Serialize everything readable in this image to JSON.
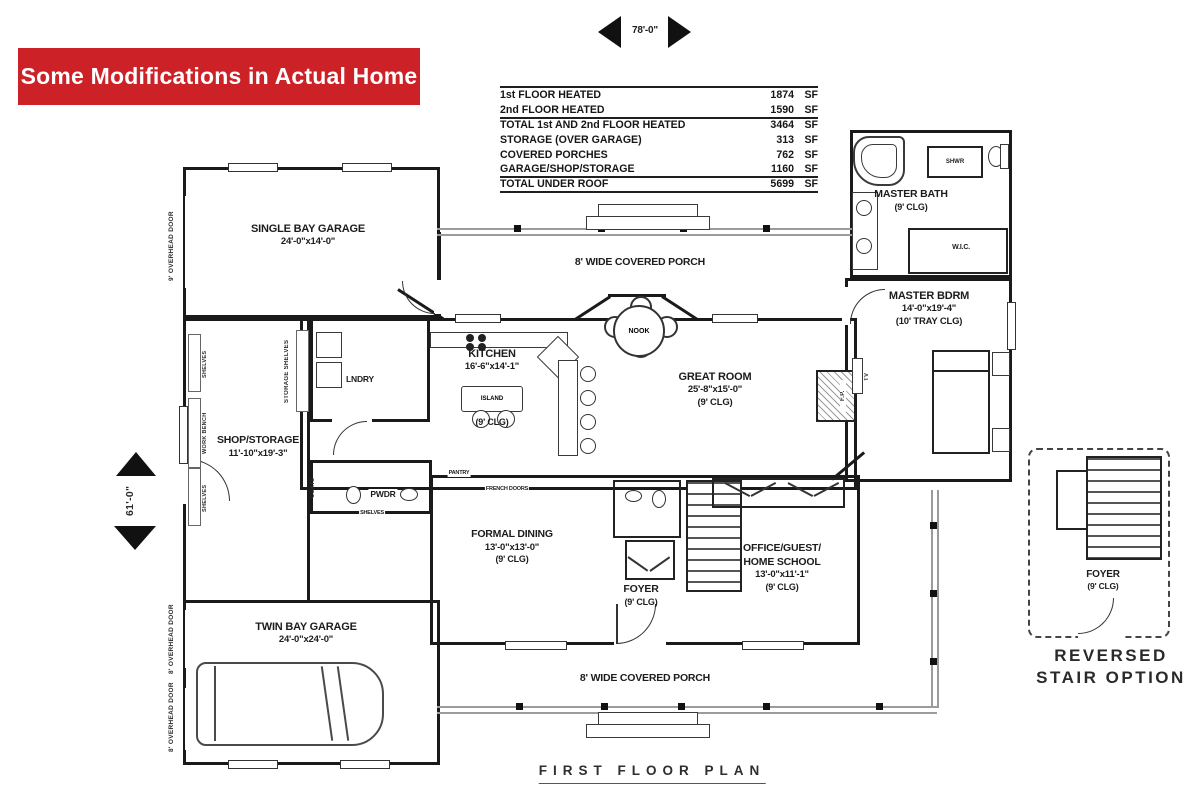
{
  "banner": {
    "text": "Some Modifications in Actual Home",
    "bg": "#cb2127"
  },
  "dimensions": {
    "top": "78'-0\"",
    "left": "61'-0\""
  },
  "area_table": {
    "unit": "SF",
    "rows": [
      {
        "label": "1st FLOOR HEATED",
        "value": "1874"
      },
      {
        "label": "2nd FLOOR HEATED",
        "value": "1590"
      },
      {
        "label": "TOTAL 1st AND 2nd FLOOR HEATED",
        "value": "3464"
      },
      {
        "label": "STORAGE (OVER GARAGE)",
        "value": "313"
      },
      {
        "label": "COVERED PORCHES",
        "value": "762"
      },
      {
        "label": "GARAGE/SHOP/STORAGE",
        "value": "1160"
      },
      {
        "label": "TOTAL UNDER ROOF",
        "value": "5699"
      }
    ]
  },
  "rooms": {
    "single_bay_garage": {
      "name": "SINGLE BAY GARAGE",
      "dims": "24'-0\"x14'-0\""
    },
    "porch_top": {
      "name": "8' WIDE COVERED PORCH"
    },
    "porch_bottom": {
      "name": "8' WIDE COVERED PORCH"
    },
    "master_bath": {
      "name": "MASTER BATH",
      "clg": "(9' CLG)"
    },
    "master_bdrm": {
      "name": "MASTER BDRM",
      "dims": "14'-0\"x19'-4\"",
      "clg": "(10' TRAY CLG)"
    },
    "kitchen": {
      "name": "KITCHEN",
      "dims": "16'-6\"x14'-1\"",
      "clg": "(9' CLG)"
    },
    "great_room": {
      "name": "GREAT ROOM",
      "dims": "25'-8\"x15'-0\"",
      "clg": "(9' CLG)"
    },
    "lndry": {
      "name": "LNDRY"
    },
    "shop_storage": {
      "name": "SHOP/STORAGE",
      "dims": "11'-10\"x19'-3\""
    },
    "pwdr": {
      "name": "PWDR"
    },
    "formal_dining": {
      "name": "FORMAL DINING",
      "dims": "13'-0\"x13'-0\"",
      "clg": "(9' CLG)"
    },
    "foyer": {
      "name": "FOYER",
      "clg": "(9' CLG)"
    },
    "office": {
      "name1": "OFFICE/GUEST/",
      "name2": "HOME SCHOOL",
      "dims": "13'-0\"x11'-1\"",
      "clg": "(9' CLG)"
    },
    "twin_bay_garage": {
      "name": "TWIN BAY GARAGE",
      "dims": "24'-0\"x24'-0\""
    },
    "reversed_foyer": {
      "name": "FOYER",
      "clg": "(9' CLG)"
    }
  },
  "fixtures": {
    "island": "ISLAND",
    "nook": "NOOK",
    "shwr": "SHWR",
    "wic": "W.I.C.",
    "fp": "F.P.",
    "tv": "TV"
  },
  "wall_labels": {
    "overhead_door_single": "9' OVERHEAD DOOR",
    "overhead_door_twin": "8' OVERHEAD DOOR",
    "storage_shelves": "STORAGE SHELVES",
    "shelves": "SHELVES",
    "work_bench": "WORK BENCH",
    "coats": "COATS",
    "pantry": "PANTRY",
    "french_doors": "FRENCH DOORS"
  },
  "captions": {
    "plan_title": "FIRST FLOOR PLAN",
    "reversed_line1": "REVERSED",
    "reversed_line2": "STAIR OPTION"
  }
}
